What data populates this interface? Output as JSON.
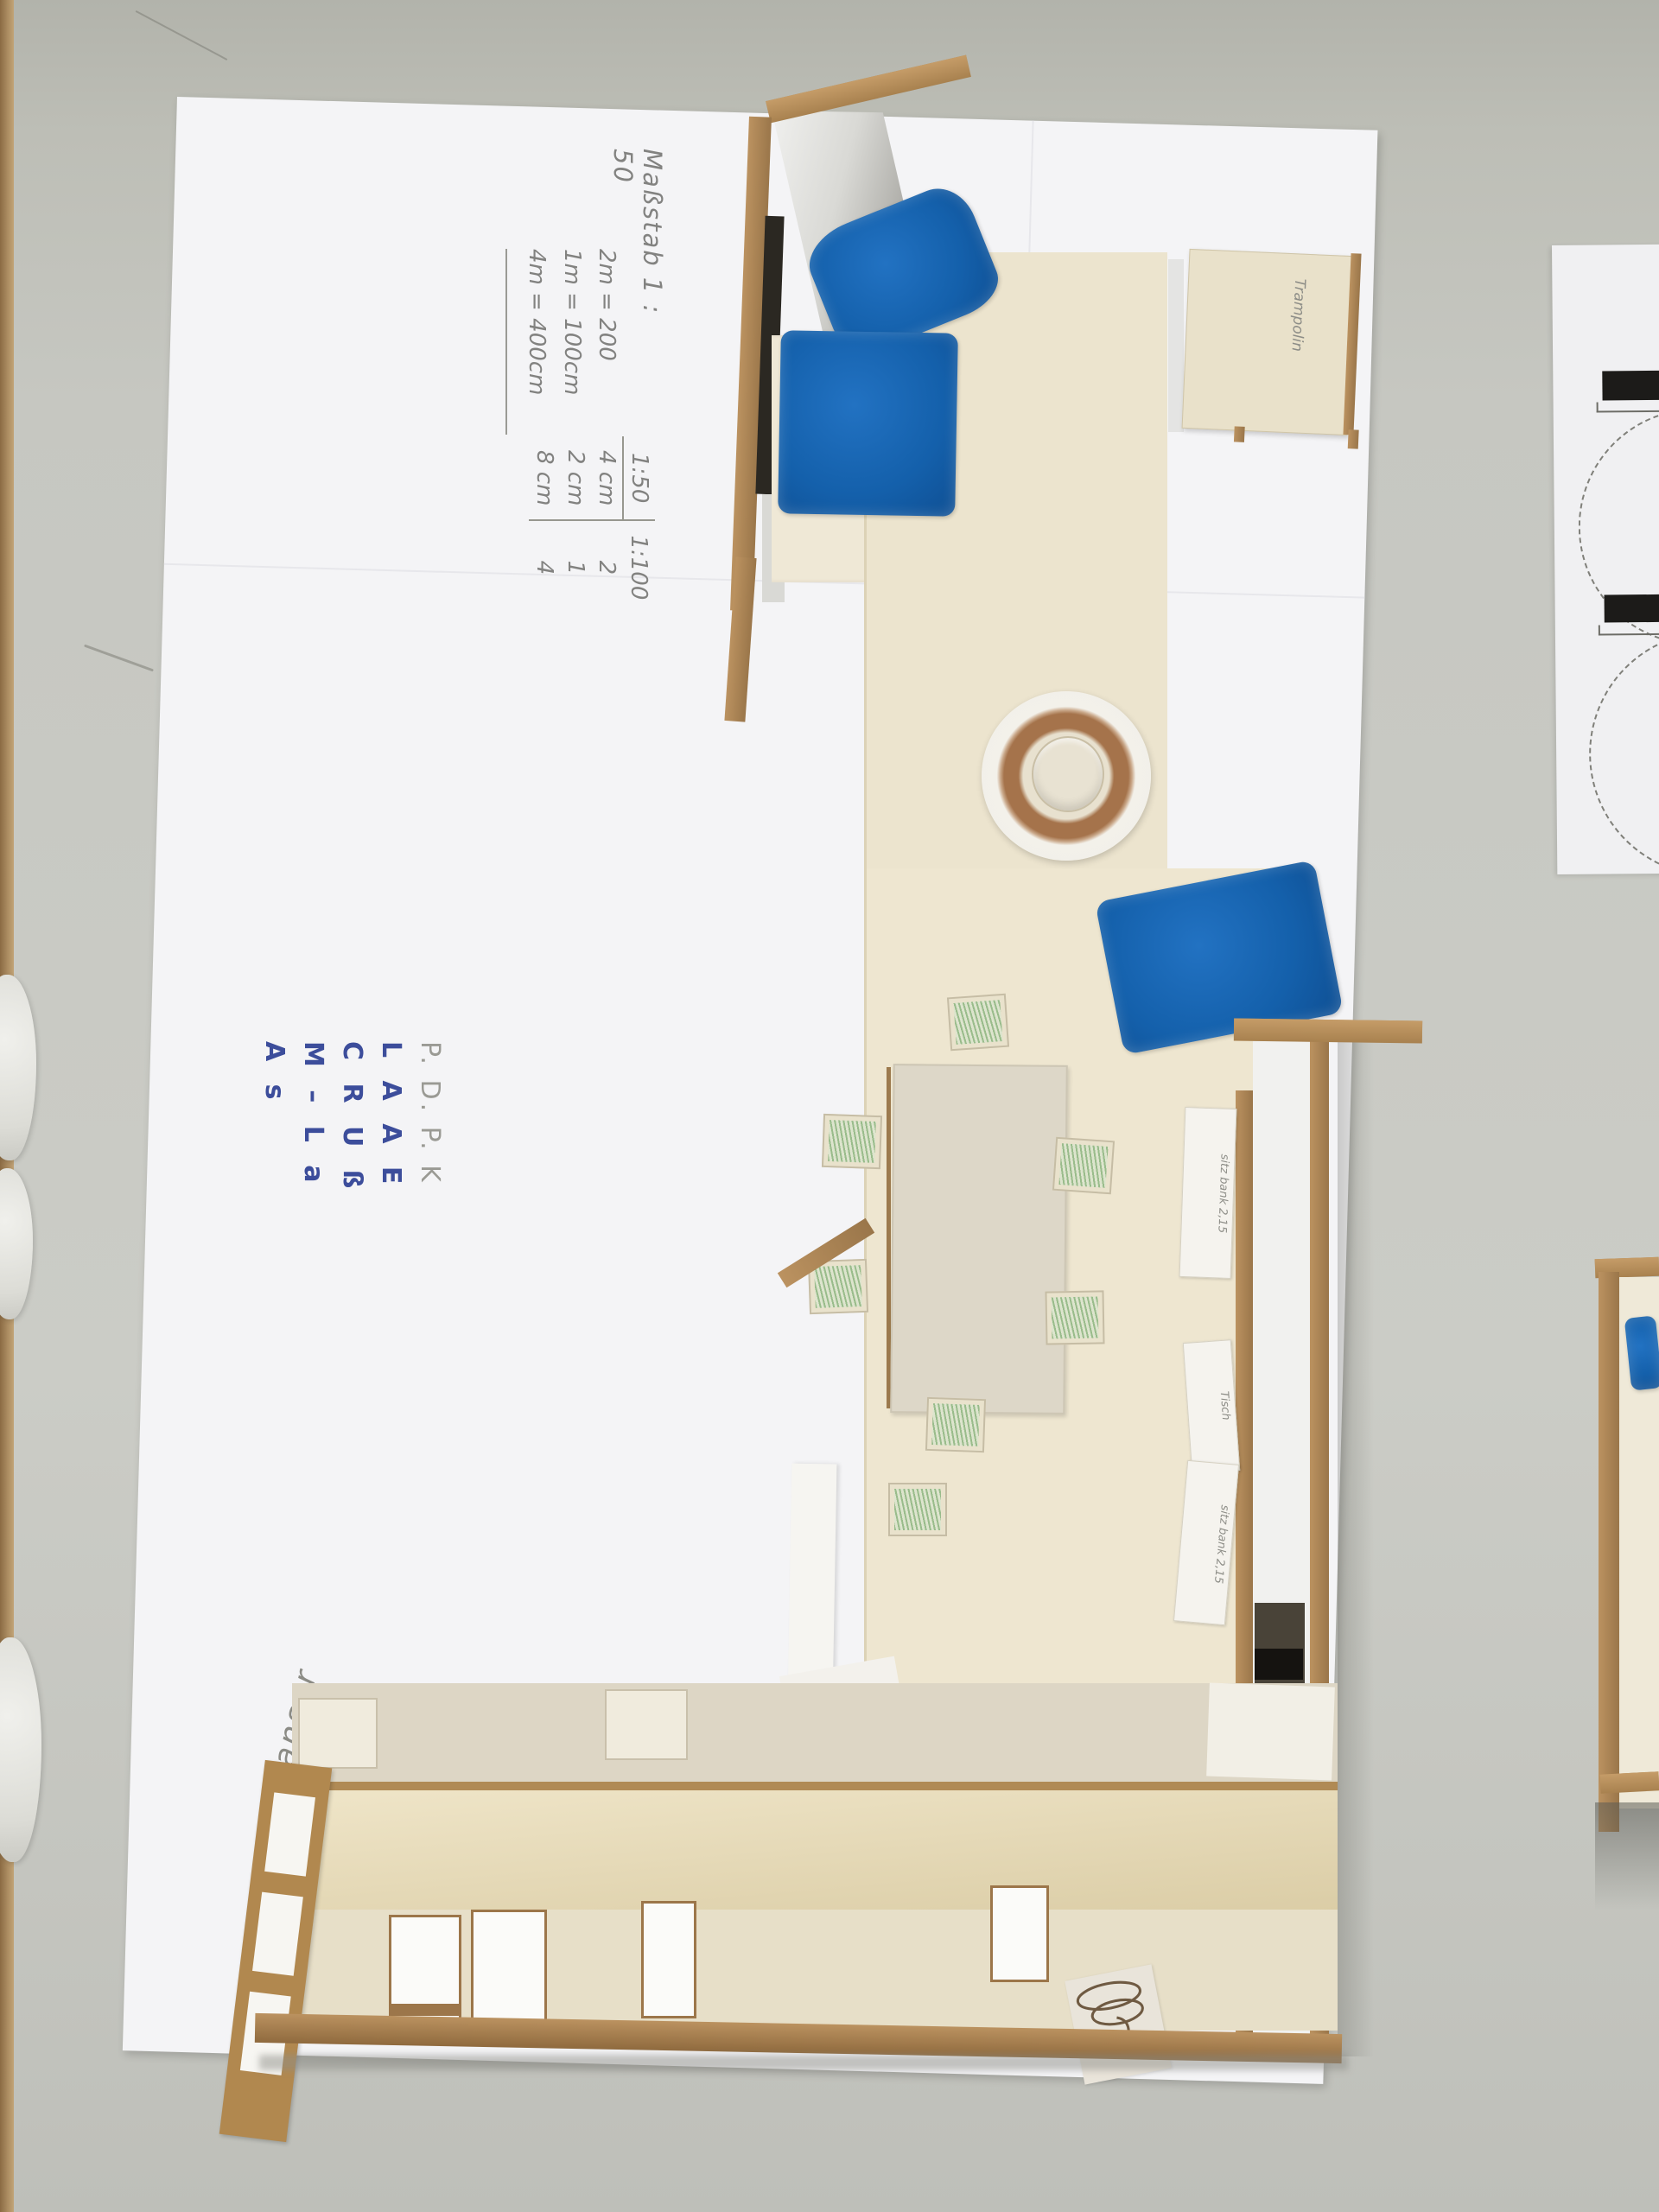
{
  "annotations": {
    "massstab_title": "Maßstab  1 : 50",
    "conversions": [
      "2m = 200",
      "1m = 100cm",
      "4m = 400cm"
    ],
    "scale_table": {
      "headers": [
        "1:50",
        "1:100"
      ],
      "rows": [
        [
          "4 cm",
          "2"
        ],
        [
          "2 cm",
          "1"
        ],
        [
          "8 cm",
          "4"
        ]
      ]
    },
    "names": {
      "initials": "P. D. P. K",
      "rows": [
        "L A A E",
        "C R U ß",
        "M – L a",
        "A s"
      ]
    },
    "signature": "Janser"
  },
  "model_labels": {
    "trampolin": "Trampolin",
    "strips": [
      "sitz bank 2,15",
      "Tisch",
      "sitz bank 2,15"
    ]
  },
  "colors": {
    "felt_blue": "#1565b2",
    "mdf_wood": "#ab854f",
    "floor_cream": "#ece4ce",
    "stool_green": "#bcd7b4",
    "table_gray": "#c6c7c1",
    "paper_white": "#f4f4f6",
    "plan_black": "#1c1b19"
  }
}
